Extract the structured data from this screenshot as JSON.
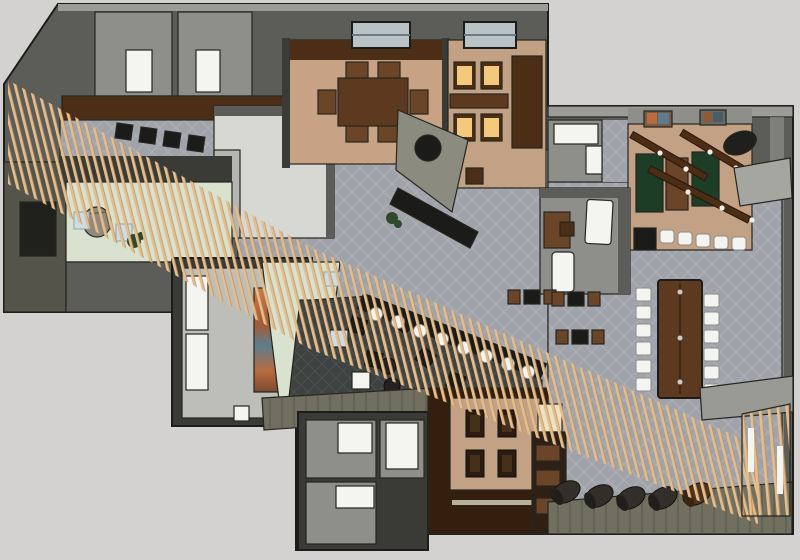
{
  "scene": {
    "type": "3d-floor-plan-render",
    "view": "top-down"
  },
  "palette": {
    "bg": "#d3d2d0",
    "wall_dark": "#3a3a37",
    "wall_mid": "#5c5c58",
    "wall_light": "#9b9b98",
    "wall_olive": "#716f60",
    "room_gray": "#8e8e8b",
    "floor_tile": "#a0a4aa",
    "floor_tile_line": "#b3b7bd",
    "floor_dark": "#3e4241",
    "floor_dark_line": "#545857",
    "carpet_tan": "#c7a284",
    "brick_tan": "#c2a184",
    "wood_dark": "#4c2d16",
    "wood_mid": "#6b4528",
    "wood_table": "#5d3a1f",
    "slat_wood": "#e4bd8d",
    "slat_edge": "#bb8f5e",
    "white_furniture": "#f4f4f1",
    "cream": "#efe2c0",
    "pale_green": "#d9e2cf",
    "glass_blue": "#ccdde6",
    "seat_amber": "#f2c97d",
    "green_felt": "#1e3d27",
    "black_counter": "#1b1b1a",
    "mural_orange": "#c06a3c",
    "mural_blue": "#5c7d8e",
    "skylight_glass": "#b9c3c7",
    "cylinder_dark": "#322f2b",
    "rock_gray": "#90897f",
    "plant_green": "#2f4a2a",
    "silver": "#c8ccd0"
  },
  "areas": [
    "top-left-service-rooms",
    "kitchen",
    "private-dining-room",
    "amber-booth-room",
    "games-room",
    "office-room",
    "central-dining-hall",
    "communal-table-area",
    "diagonal-bar",
    "lounge",
    "gallery-corridor",
    "entry-area",
    "restrooms",
    "brick-booth-pit",
    "cylinder-stool-row",
    "slat-ceiling-screen"
  ]
}
